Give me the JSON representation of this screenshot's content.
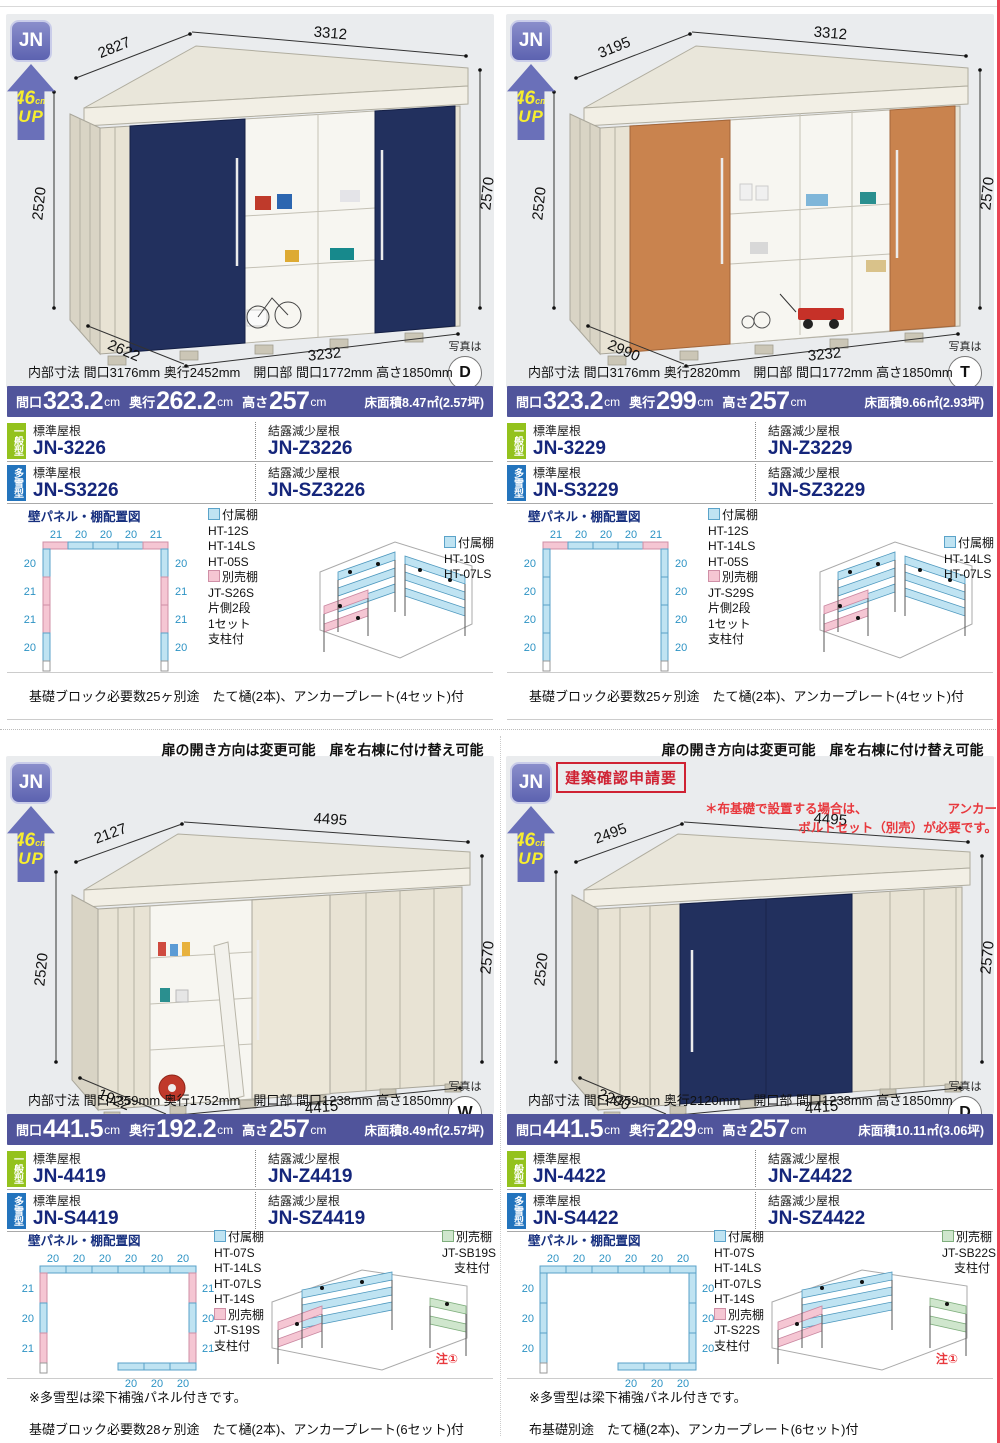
{
  "common": {
    "series": "JN",
    "up_value": "46",
    "up_unit": "cm",
    "up_word": "UP",
    "photo_label": "写真は",
    "wall_title": "壁パネル・棚配置図",
    "attached": "付属棚",
    "optional": "別売棚",
    "std_roof": "標準屋根",
    "dew_roof": "結露減少屋根",
    "general": "一般型",
    "snow": "多雪型",
    "spec_w": "間口",
    "spec_d": "奥行",
    "spec_h": "高さ",
    "unit_cm": "cm",
    "door_note": "扉の開き方向は変更可能　扉を右棟に付け替え可能",
    "snow_panel_note": "※多雪型は梁下補強パネル付きです。",
    "note_mark": "注①",
    "approval": "建築確認申請要",
    "red_note_a": "＊布基礎で設置する場合は、",
    "red_note_b": "アンカー",
    "red_note_c": "ボルトセット（別売）が必要です。"
  },
  "products": [
    {
      "dims": {
        "roof_side": "2827",
        "roof_front": "3312",
        "height_left": "2520",
        "height_right": "2570",
        "base_side": "2622",
        "base_front": "3232"
      },
      "photo": "D",
      "inner_spec": "内部寸法 間口3176mm 奥行2452mm　開口部 間口1772mm 高さ1850mm",
      "spec": {
        "w": "323.2",
        "d": "262.2",
        "h": "257",
        "floor": "床面積8.47㎡(2.57坪)"
      },
      "models": {
        "g_std": "JN-3226",
        "g_dew": "JN-Z3226",
        "s_std": "JN-S3226",
        "s_dew": "JN-SZ3226"
      },
      "panel": {
        "top": [
          "21",
          "20",
          "20",
          "20",
          "21"
        ],
        "left": [
          "20",
          "21",
          "21",
          "20"
        ],
        "right": [
          "20",
          "21",
          "21",
          "20"
        ]
      },
      "shelf_left": {
        "attached": [
          "HT-12S",
          "HT-14LS",
          "HT-05S"
        ],
        "optional": [
          "JT-S26S",
          "片側2段",
          "1セット",
          "支柱付"
        ]
      },
      "shelf_right": {
        "attached": [
          "HT-10S",
          "HT-07LS"
        ]
      },
      "foot_note": "基礎ブロック必要数25ヶ別途　たて樋(2本)、アンカープレート(4セット)付"
    },
    {
      "dims": {
        "roof_side": "3195",
        "roof_front": "3312",
        "height_left": "2520",
        "height_right": "2570",
        "base_side": "2990",
        "base_front": "3232"
      },
      "photo": "T",
      "inner_spec": "内部寸法 間口3176mm 奥行2820mm　開口部 間口1772mm 高さ1850mm",
      "spec": {
        "w": "323.2",
        "d": "299",
        "h": "257",
        "floor": "床面積9.66㎡(2.93坪)"
      },
      "models": {
        "g_std": "JN-3229",
        "g_dew": "JN-Z3229",
        "s_std": "JN-S3229",
        "s_dew": "JN-SZ3229"
      },
      "panel": {
        "top": [
          "21",
          "20",
          "20",
          "20",
          "21"
        ],
        "left": [
          "20",
          "20",
          "20",
          "20"
        ],
        "right": [
          "20",
          "20",
          "20",
          "20"
        ]
      },
      "shelf_left": {
        "attached": [
          "HT-12S",
          "HT-14LS",
          "HT-05S"
        ],
        "optional": [
          "JT-S29S",
          "片側2段",
          "1セット",
          "支柱付"
        ]
      },
      "shelf_right": {
        "attached": [
          "HT-14LS",
          "HT-07LS"
        ]
      },
      "foot_note": "基礎ブロック必要数25ヶ別途　たて樋(2本)、アンカープレート(4セット)付"
    },
    {
      "dims": {
        "roof_side": "2127",
        "roof_front": "4495",
        "height_left": "2520",
        "height_right": "2570",
        "base_side": "1922",
        "base_front": "4415"
      },
      "photo": "W",
      "inner_spec": "内部寸法 間口4359mm 奥行1752mm　開口部 間口1238mm 高さ1850mm",
      "spec": {
        "w": "441.5",
        "d": "192.2",
        "h": "257",
        "floor": "床面積8.49㎡(2.57坪)"
      },
      "models": {
        "g_std": "JN-4419",
        "g_dew": "JN-Z4419",
        "s_std": "JN-S4419",
        "s_dew": "JN-SZ4419"
      },
      "panel": {
        "top": [
          "20",
          "20",
          "20",
          "20",
          "20",
          "20"
        ],
        "left": [
          "21",
          "20",
          "21"
        ],
        "right": [
          "21",
          "20",
          "21"
        ],
        "bottom": [
          "20",
          "20",
          "20"
        ]
      },
      "shelf_left": {
        "attached": [
          "HT-07S",
          "HT-14LS",
          "HT-07LS",
          "HT-14S"
        ],
        "optional": [
          "JT-S19S",
          "支柱付"
        ]
      },
      "shelf_right": {
        "optional": [
          "JT-SB19S",
          "支柱付"
        ]
      },
      "snow_note": "※多雪型は梁下補強パネル付きです。",
      "foot_note": "基礎ブロック必要数28ヶ別途　たて樋(2本)、アンカープレート(6セット)付"
    },
    {
      "dims": {
        "roof_side": "2495",
        "roof_front": "4495",
        "height_left": "2520",
        "height_right": "2570",
        "base_side": "2290",
        "base_front": "4415"
      },
      "photo": "D",
      "inner_spec": "内部寸法 間口4359mm 奥行2120mm　開口部 間口1238mm 高さ1850mm",
      "spec": {
        "w": "441.5",
        "d": "229",
        "h": "257",
        "floor": "床面積10.11㎡(3.06坪)"
      },
      "models": {
        "g_std": "JN-4422",
        "g_dew": "JN-Z4422",
        "s_std": "JN-S4422",
        "s_dew": "JN-SZ4422"
      },
      "panel": {
        "top": [
          "20",
          "20",
          "20",
          "20",
          "20",
          "20"
        ],
        "left": [
          "20",
          "20",
          "20"
        ],
        "right": [
          "20",
          "20",
          "20"
        ],
        "bottom": [
          "20",
          "20",
          "20"
        ]
      },
      "shelf_left": {
        "attached": [
          "HT-07S",
          "HT-14LS",
          "HT-07LS",
          "HT-14S"
        ],
        "optional": [
          "JT-S22S",
          "支柱付"
        ]
      },
      "shelf_right": {
        "optional": [
          "JT-SB22S",
          "支柱付"
        ]
      },
      "snow_note": "※多雪型は梁下補強パネル付きです。",
      "foot_note": "布基礎別途　たて樋(2本)、アンカープレート(6セット)付"
    }
  ]
}
